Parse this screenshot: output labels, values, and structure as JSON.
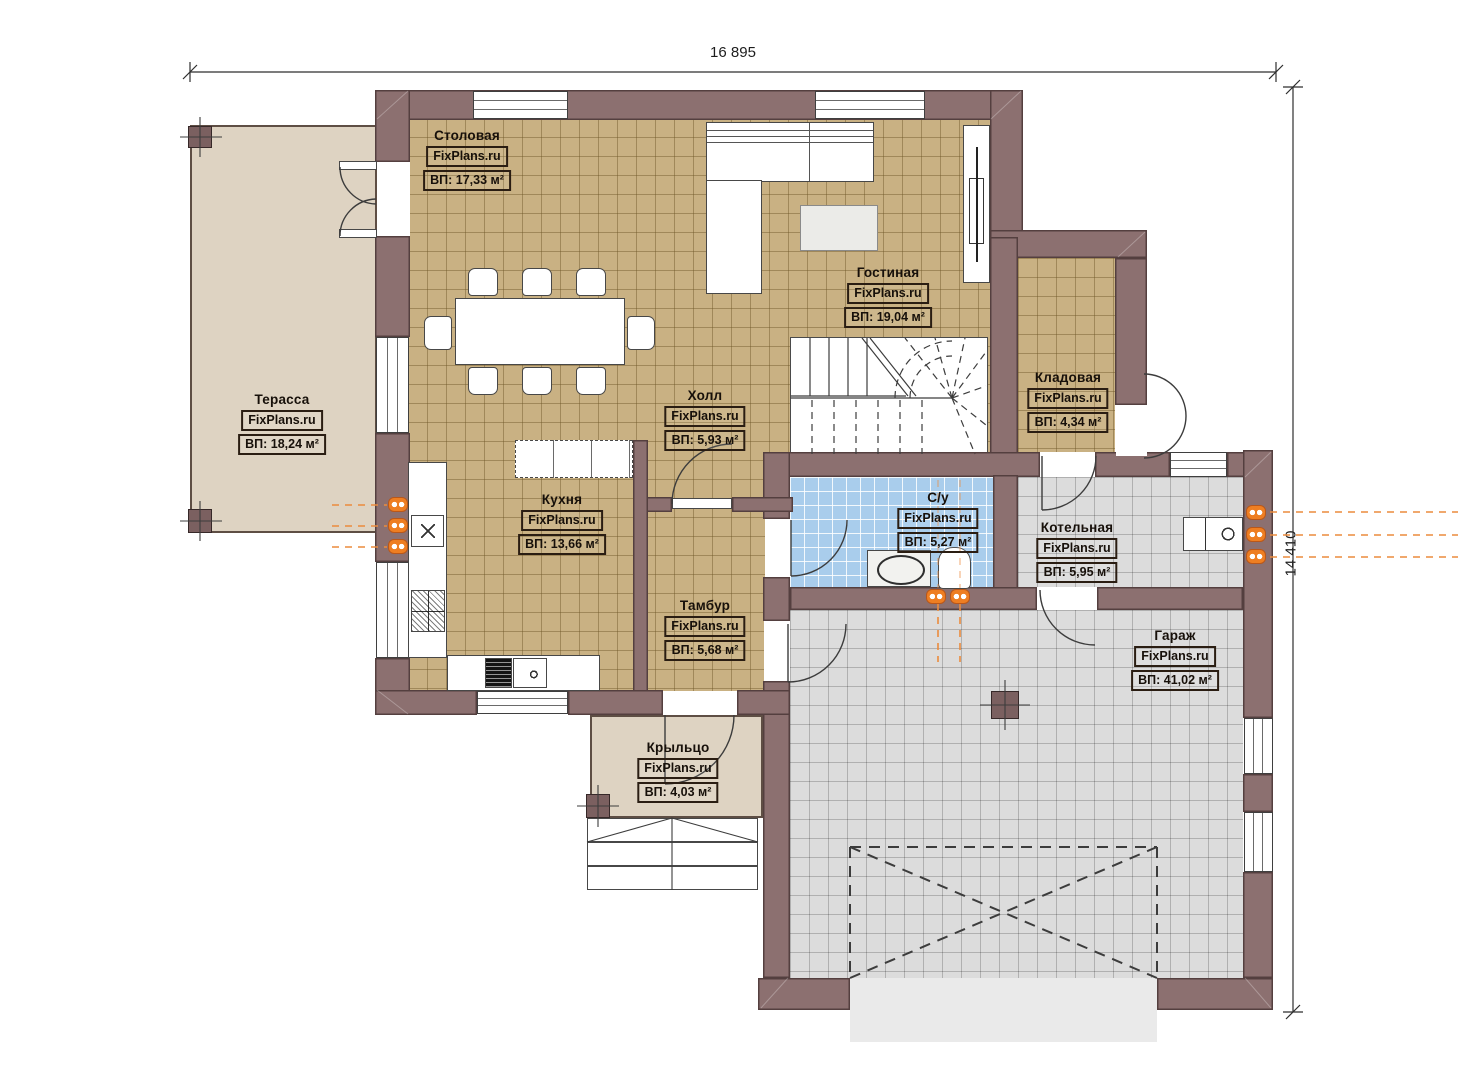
{
  "plan": {
    "watermark": "FixPlans.ru",
    "dimensions": {
      "top": "16 895",
      "right": "14 410"
    },
    "rooms": [
      {
        "name": "Столовая",
        "watermark": "FixPlans.ru",
        "area": "ВП: 17,33 м²"
      },
      {
        "name": "Гостиная",
        "watermark": "FixPlans.ru",
        "area": "ВП: 19,04 м²"
      },
      {
        "name": "Терасса",
        "watermark": "FixPlans.ru",
        "area": "ВП: 18,24 м²"
      },
      {
        "name": "Холл",
        "watermark": "FixPlans.ru",
        "area": "ВП: 5,93 м²"
      },
      {
        "name": "Кладовая",
        "watermark": "FixPlans.ru",
        "area": "ВП: 4,34 м²"
      },
      {
        "name": "Кухня",
        "watermark": "FixPlans.ru",
        "area": "ВП: 13,66 м²"
      },
      {
        "name": "С/у",
        "watermark": "FixPlans.ru",
        "area": "ВП: 5,27 м²"
      },
      {
        "name": "Котельная",
        "watermark": "FixPlans.ru",
        "area": "ВП: 5,95 м²"
      },
      {
        "name": "Тамбур",
        "watermark": "FixPlans.ru",
        "area": "ВП: 5,68 м²"
      },
      {
        "name": "Гараж",
        "watermark": "FixPlans.ru",
        "area": "ВП: 41,02 м²"
      },
      {
        "name": "Крыльцо",
        "watermark": "FixPlans.ru",
        "area": "ВП: 4,03 м²"
      }
    ],
    "colors": {
      "wall": "#8c7070",
      "floor_tile": "#c9b183",
      "garage_tile": "#dcdcdc",
      "bath_tile": "#a9cdec",
      "terrace": "#ded3c2",
      "radiator": "#ee7e22"
    }
  }
}
